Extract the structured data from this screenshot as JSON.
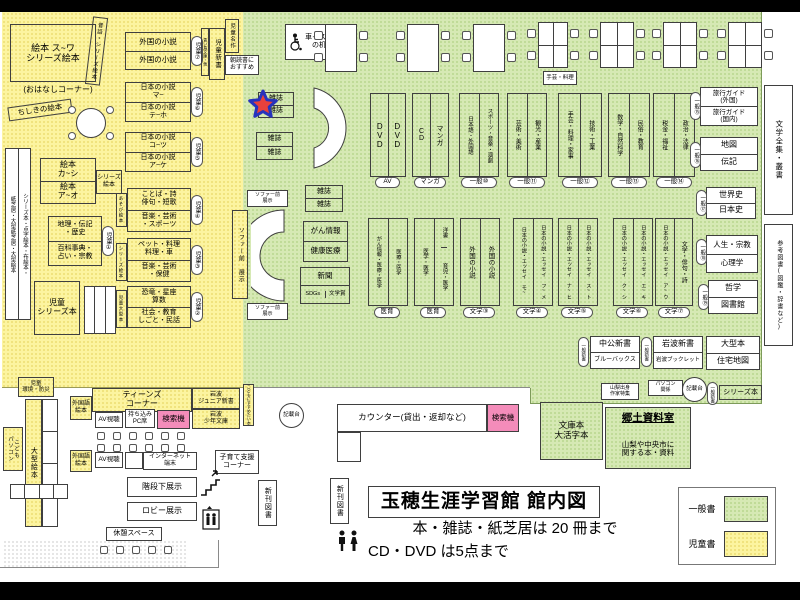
{
  "title_block": {
    "title": "玉穂生涯学習館 館内図",
    "note1": "本・雑誌・紙芝居は 20 冊まで",
    "note2": "CD・DVD は5点まで"
  },
  "legend": {
    "general": "一般書",
    "children": "児童書"
  },
  "colors": {
    "general_area": "#d6e9b4",
    "children_area": "#fcf4a0",
    "search_machine": "#f48cba",
    "star_fill": "#e8413c",
    "star_stroke": "#2733bd"
  },
  "children": {
    "ehon_main": "絵本 ス~ワ\nシリーズ絵本",
    "ohanashi": "(おはなしコーナー)",
    "mukashibanashi": "昔話・シリーズ絵本",
    "chishiki": "ちしきの絵本",
    "tall_left_col": "紙芝居・大型紙芝居・大型絵本",
    "tall_right_col": "シリーズ本・点字絵本・布絵本・",
    "ehon_kashi": "絵本\nカ~シ",
    "ehon_ao": "絵本\nア~オ",
    "series_ehon_tag": "シリーズ\n絵本",
    "chiri": "地理・伝記\n・歴史",
    "hyakka": "百科事典・\n占い・宗教",
    "jido_series": "児童\nシリーズ本",
    "gaikoku_shosetsu": "外国の小説",
    "nihon_ma": "日本の小説\nマ~",
    "nihon_teho": "日本の小説\nテ~ホ",
    "nihon_kotsu": "日本の小説\nコ~ツ",
    "nihon_ake": "日本の小説\nア~ケ",
    "kotoba_top": "ことば・詩\n俳句・短歌",
    "kotoba_bottom": "音楽・芸術\n・スポーツ",
    "asobi_tag": "あそび絵本",
    "pet_top": "ペット・料理\n料理・車",
    "pet_bottom": "音楽・芸術\n・保健",
    "series_tag2": "シリーズ絵本",
    "kyoryu_top": "恐竜・星座\n算数",
    "kyoryu_bottom": "社会・教育\nしごと・民話",
    "ogata_tag": "児童大型本",
    "pills": {
      "p1": "児童①",
      "p2": "児童②",
      "p3": "児童③",
      "p4": "児童④",
      "p5": "児童⑤",
      "p6": "児童⑥",
      "p7": "児童⑦"
    },
    "aoitori_tag": "青い鳥文庫・他",
    "jido_shinsho": "児童新書",
    "jido_meisaku": "児童名作",
    "asadoku": "朝読書に\nおすすめ",
    "kankyo_bosai": "児童\n環境・防災",
    "ogata_ehon": "大型絵本",
    "kodomo_pasokon": "こども\nパソコン",
    "teens_corner": "ティーンズ\nコーナー",
    "gaikokugo_ehon": "外国語\n絵本",
    "av_shicho": "AV視聴",
    "mochikomi_pc": "持ち込み\nPC席",
    "kensakuki": "検索機",
    "iwanami_junior": "岩波\nジュニア新書",
    "iwanami_shonen": "岩波\n少年文庫",
    "kodomo_susume": "こどもにすすめたい本"
  },
  "general": {
    "wheelchair_desk": "車イス用\nの机",
    "zasshi": "雑誌",
    "sofa_front": "ソファー前\n展示",
    "sofa_front_v": "ソファー前 展示",
    "gan_joho": "がん情報",
    "kenko_iryo": "健康医療",
    "shinbun": "新聞",
    "sdgs": "SDGs",
    "bungakusho": "文学賞",
    "dvd": "DVD",
    "cd": "CD",
    "manga": "マンガ",
    "pill_av": "AV",
    "pill_manga": "マンガ",
    "shelf10": [
      "日本語・外国語",
      "スポーツ・音楽・演劇"
    ],
    "shelf11": [
      "芸術・美術",
      "観光・産業"
    ],
    "shelf12": [
      "手芸・料理・家事",
      "技術・工業"
    ],
    "shelf13": [
      "数学・自然科学",
      "民俗・教育"
    ],
    "shelf14": [
      "税金・福祉",
      "政治・法律"
    ],
    "pill10": "一般⑩",
    "pill11": "一般⑪",
    "pill12": "一般⑫",
    "pill13": "一般⑬",
    "pill14": "一般⑭",
    "shugei_tag": "手芸・料理",
    "ryoko_gaikoku": "旅行ガイド\n(外国)",
    "ryoko_kokunai": "旅行ガイド\n(国内)",
    "pill15": "一般⑮",
    "chizu": "地図",
    "denki": "伝記",
    "pill16": "一般⑯",
    "sekaishi": "世界史",
    "nihonshi": "日本史",
    "pill17": "一般⑰",
    "jinsei": "人生・宗教",
    "shinrigaku": "心理学",
    "pill18": "一般⑱",
    "tetsugaku": "哲学",
    "toshokan": "図書館",
    "pill19": "一般⑲",
    "bungaku_zenshu": "文学全集・叢書",
    "sanko_tosho": "参考図書(図鑑・辞書など)",
    "med1": [
      "がん情報・医療・医学",
      "医療・医学"
    ],
    "med2_left": "医学・医学",
    "med2_yosho": "洋書",
    "med2_ikuji": "育児・医学",
    "pill_med": "医育",
    "f3": [
      "外国の小説",
      "外国の小説"
    ],
    "f4": [
      "日本の小説・エッセイ モ~",
      "日本の小説・エッセイ フ~メ"
    ],
    "f5": [
      "日本の小説・エッセイ ナ~ヒ",
      "日本の小説・エッセイ ス~ト"
    ],
    "f6": [
      "日本の小説・エッセイ ク~シ",
      "日本の小説・エッセイ エ~キ"
    ],
    "f7": [
      "日本の小説・エッセイ ア~ウ",
      "文学・俳句・詩"
    ],
    "pill_f3": "文学③",
    "pill_f4": "文学④",
    "pill_f5": "文学⑤",
    "pill_f6": "文学⑥",
    "pill_f7": "文学⑦",
    "chuko": "中公新書",
    "bluebacks": "ブルーバックス",
    "iwanami_shinsho": "岩波新書",
    "iwanami_booklet": "岩波ブックレット",
    "pill_shinsho": "一般新書",
    "ogata_hon": "大型本",
    "jutaku_chizu": "住宅地図",
    "yamanashi_tag": "山梨出身\n作家特集",
    "pasokon_tag": "パソコン\n関係",
    "kisaidai": "記載台",
    "series_hon": "シリーズ本",
    "bunkobon": "文庫本\n大活字本",
    "kyodo_title": "郷土資料室",
    "kyodo_sub": "山梨や中央市に\n関する本・資料"
  },
  "facilities": {
    "counter": "カウンター(貸出・返却など)",
    "kensakuki": "検索機",
    "kosodate": "子育て支援\nコーナー",
    "internet": "インターネット\n端末",
    "kaidan_shita": "階段下展示",
    "lobby": "ロビー展示",
    "kyukei": "休憩スペース",
    "shinkan_tosho": "新刊図書"
  }
}
